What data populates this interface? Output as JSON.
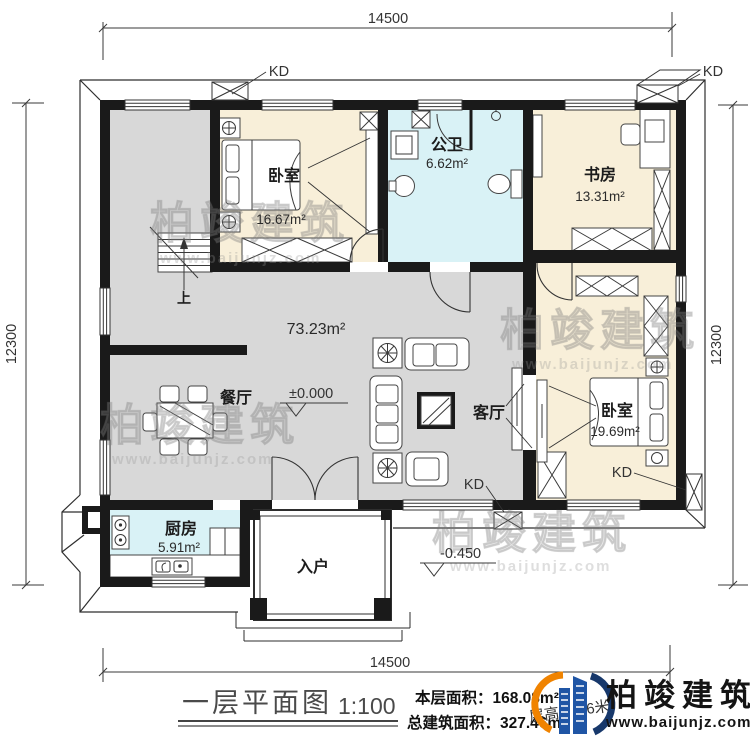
{
  "title_block": {
    "drawing_title": "一层平面图",
    "scale": "1:100",
    "floor_area_label": "本层面积：",
    "floor_area_value": "168.08m²",
    "total_area_label": "总建筑面积：",
    "total_area_value": "327.46m²",
    "floor_height": "层高：3.6米"
  },
  "brand": {
    "name": "柏竣建筑",
    "website": "www.baijunjz.com"
  },
  "watermark": {
    "text": "柏竣建筑",
    "website": "www.baijunjz.com"
  },
  "dimensions": {
    "top": "14500",
    "bottom": "14500",
    "left": "12300",
    "right": "12300"
  },
  "levels": {
    "indoor": "±0.000",
    "outdoor": "-0.450"
  },
  "annotations": {
    "kd": "KD",
    "stairs_up": "上",
    "open_area": "73.23m²"
  },
  "rooms": {
    "bedroom1": {
      "name": "卧室",
      "area": "16.67m²"
    },
    "bathroom": {
      "name": "公卫",
      "area": "6.62m²"
    },
    "study": {
      "name": "书房",
      "area": "13.31m²"
    },
    "bedroom2": {
      "name": "卧室",
      "area": "19.69m²"
    },
    "kitchen": {
      "name": "厨房",
      "area": "5.91m²"
    },
    "dining": {
      "name": "餐厅"
    },
    "living": {
      "name": "客厅"
    },
    "entry": {
      "name": "入户"
    }
  },
  "colors": {
    "wall": "#1a1a1a",
    "floor_gray": "#d8d8d8",
    "floor_cream": "#f8efd9",
    "floor_blue": "#d9f2f6",
    "brand_blue": "#1f55a5",
    "brand_orange": "#f08300"
  }
}
